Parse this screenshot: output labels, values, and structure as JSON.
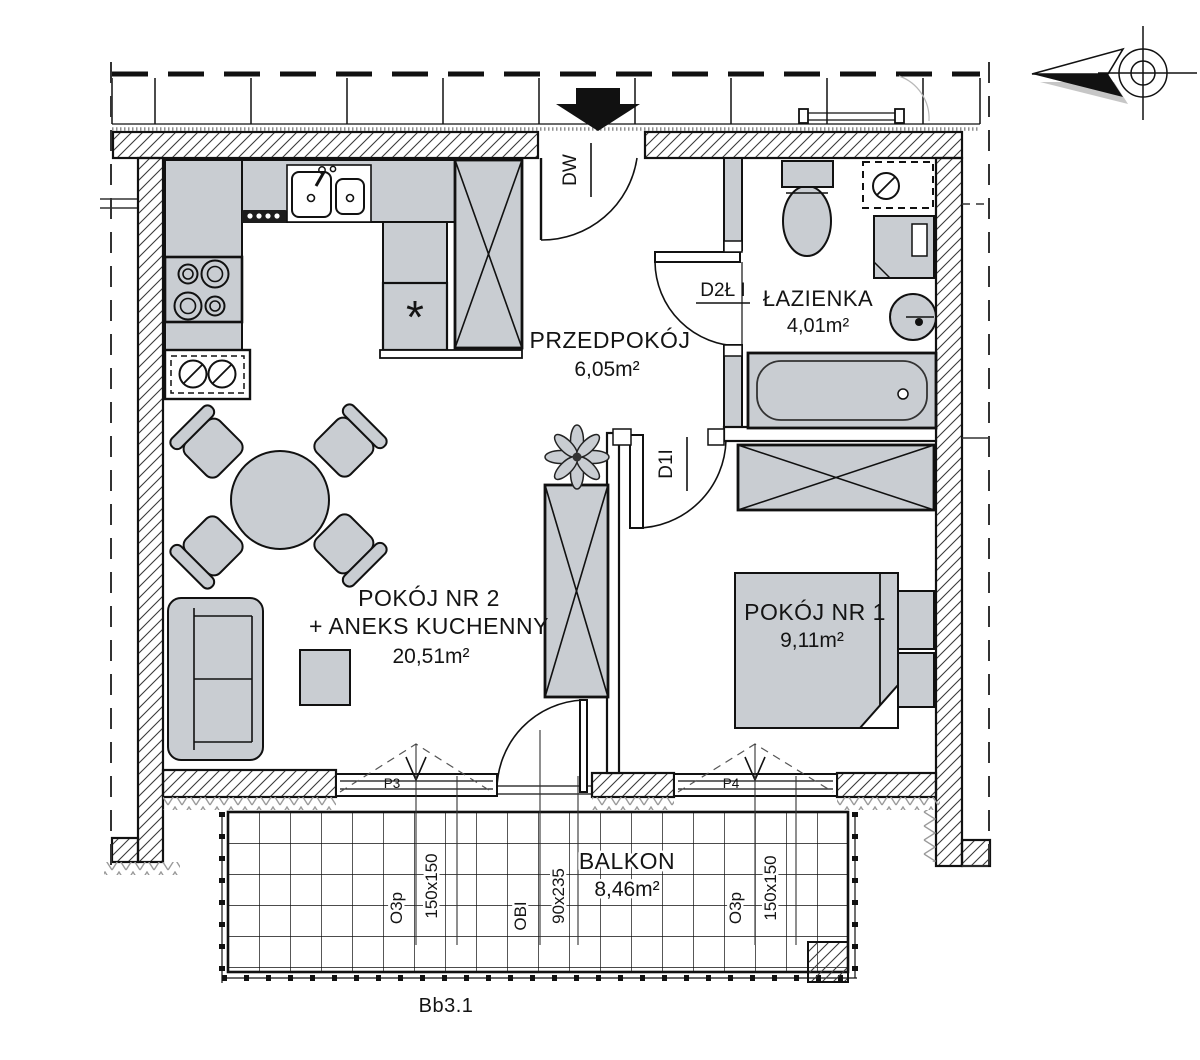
{
  "rooms": {
    "hall": {
      "name": "PRZEDPOKÓJ",
      "area": "6,05m²"
    },
    "bathroom": {
      "name": "ŁAZIENKA",
      "area": "4,01m²"
    },
    "room2": {
      "name": "POKÓJ NR 2",
      "annex": "+ ANEKS KUCHENNY",
      "area": "20,51m²"
    },
    "room1": {
      "name": "POKÓJ NR 1",
      "area": "9,11m²"
    },
    "balcony": {
      "name": "BALKON",
      "area": "8,46m²"
    }
  },
  "doors": {
    "entrance": "DW",
    "bathroom": "D2Ł I",
    "room1": "D1I",
    "balcony_type": "OBI",
    "balcony_size": "90x235"
  },
  "windows": {
    "p3": "P3",
    "p4": "P4",
    "type": "O3p",
    "size": "150x150"
  },
  "plan_code": "Bb3.1",
  "symbols": {
    "freezer": "*"
  },
  "colors": {
    "furniture_fill": "#c9cdd2",
    "line": "#111111"
  }
}
